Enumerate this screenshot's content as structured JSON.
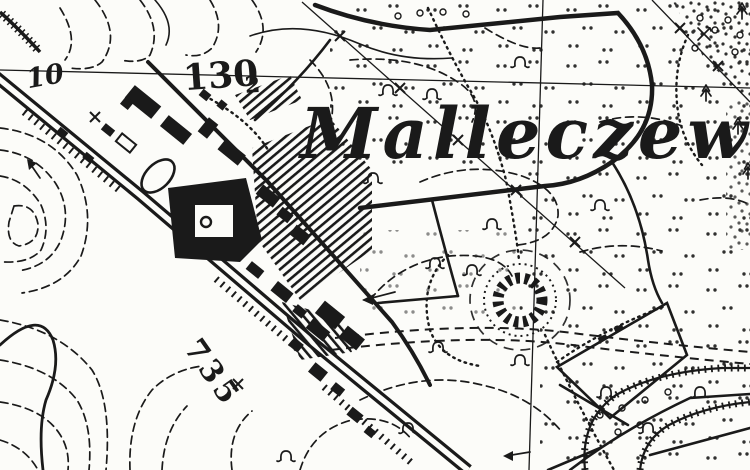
{
  "map": {
    "place_name": "Malleczewen",
    "spot_height": "130",
    "spot_height_decimal": "2",
    "grid_number": "10",
    "route_number": "735"
  },
  "colors": {
    "ink": "#1a1a1a",
    "paper": "#fcfcf9"
  }
}
